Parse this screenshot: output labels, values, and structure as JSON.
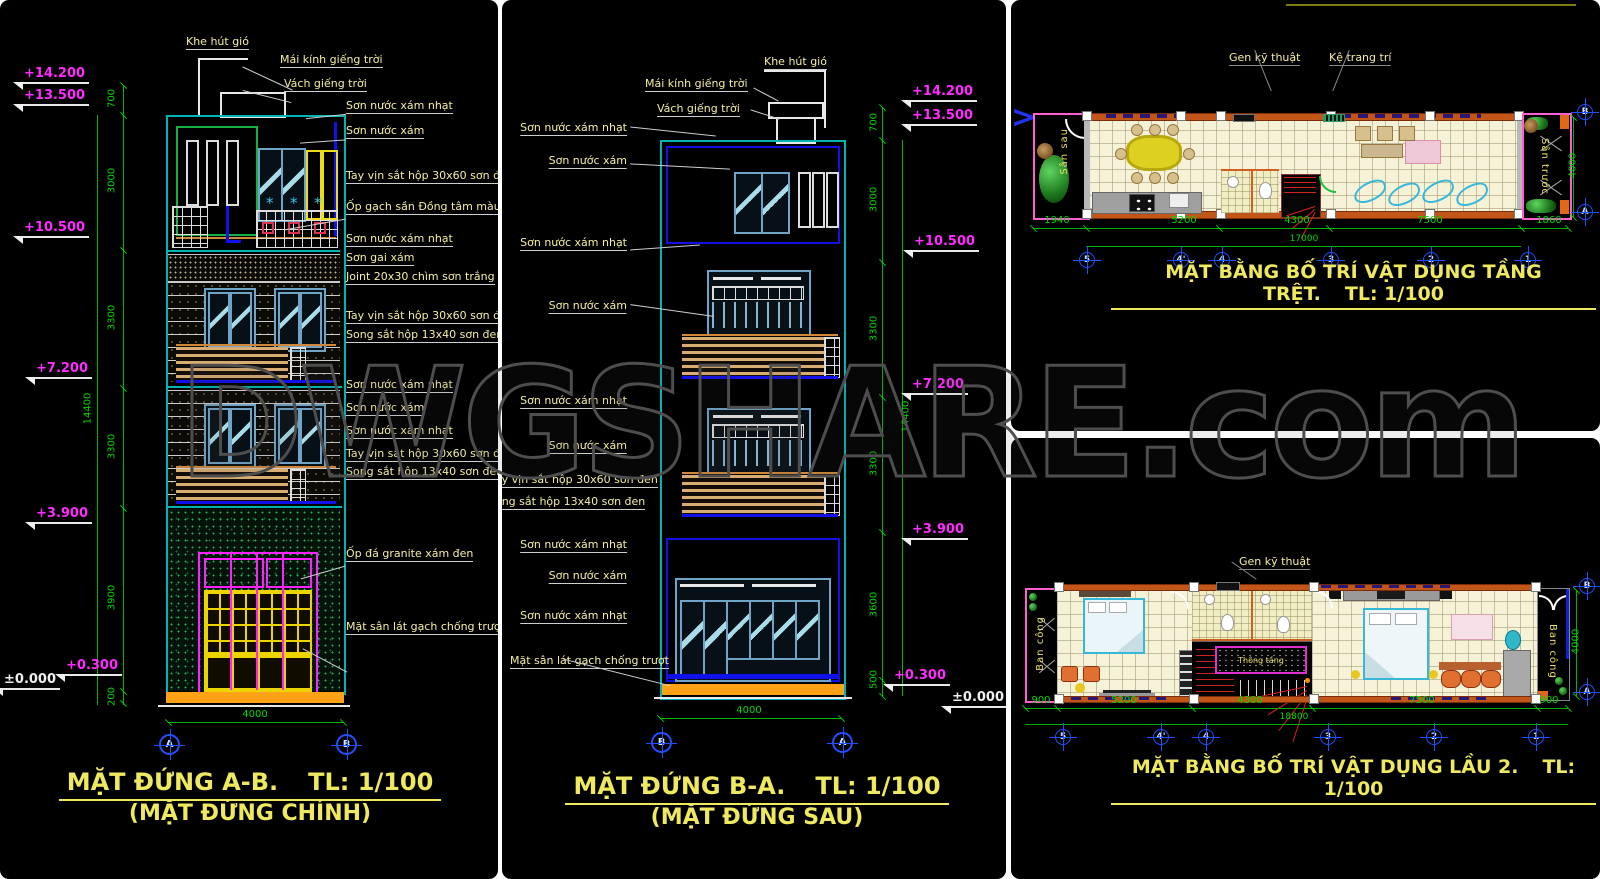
{
  "watermark": "DWGSHARE.com",
  "icons": {
    "chevron": ">",
    "plant": "*"
  },
  "front_elevation": {
    "title": "MẶT ĐỨNG A-B.",
    "scale": "TL: 1/100",
    "subtitle": "(MẶT ĐỨNG CHÍNH)",
    "roof_callouts": [
      "Khe hút gió",
      "Mái kính giếng trời",
      "Vách giếng trời"
    ],
    "material_labels": [
      "Sơn nước xám nhạt",
      "Sơn nước xám",
      "Tay vịn sắt hộp 30x60 sơn đen",
      "Ốp gạch sần Đồng tâm màu x",
      "Sơn nước xám nhạt",
      "Sơn gai xám",
      "Joint 20x30 chìm sơn trắng",
      "Tay vịn sắt hộp 30x60 sơn đen",
      "Song sắt hộp 13x40 sơn đen",
      "Sơn nước xám nhạt",
      "Sơn nước xám",
      "Sơn nước xám nhạt",
      "Tay vịn sắt hộp 30x60 sơn đen",
      "Song sắt hộp 13x40 sơn đen",
      "Ốp đá granite xám đen",
      "Mặt sân lát gạch chống trượt"
    ],
    "levels": [
      "+14.200",
      "+13.500",
      "+10.500",
      "+7.200",
      "+3.900",
      "+0.300",
      "±0.000"
    ],
    "floor_dims": [
      "700",
      "3000",
      "3300",
      "3300",
      "3900",
      "200"
    ],
    "total_height": "14400",
    "width_dim": "4000",
    "grid_bubbles": [
      "A",
      "B"
    ]
  },
  "rear_elevation": {
    "title": "MẶT ĐỨNG B-A.",
    "scale": "TL: 1/100",
    "subtitle": "(MẶT ĐỨNG SAU)",
    "roof_callouts": [
      "Mái kính giếng trời",
      "Vách giếng trời",
      "Khe hút gió"
    ],
    "material_labels": [
      "Sơn nước xám nhạt",
      "Sơn nước xám",
      "Sơn nước xám nhạt",
      "Sơn nước xám",
      "Sơn nước xám nhạt",
      "Sơn nước xám",
      "Tay vịn sắt hộp 30x60 sơn đen",
      "Song sắt hộp 13x40 sơn đen",
      "Sơn nước xám nhạt",
      "Sơn nước xám",
      "Sơn nước xám nhạt",
      "Mặt sân lát gạch chống trượt"
    ],
    "levels": [
      "+14.200",
      "+13.500",
      "+10.500",
      "+7.200",
      "+3.900",
      "+0.300",
      "±0.000"
    ],
    "floor_dims": [
      "700",
      "3000",
      "3300",
      "3300",
      "3600",
      "500"
    ],
    "total_height": "14400",
    "width_dim": "4000",
    "grid_bubbles": [
      "B",
      "A"
    ]
  },
  "ground_plan": {
    "title": "MẶT BẰNG BỐ TRÍ VẬT DỤNG TẦNG TRỆT.",
    "scale": "TL: 1/100",
    "callouts": [
      "Gen kỹ thuật",
      "Kệ trang trí"
    ],
    "area_labels": [
      "Sân sau",
      "Sân trước"
    ],
    "dims": [
      "1940",
      "5200",
      "4300",
      "7500",
      "1860"
    ],
    "total_dim": "17000",
    "depth_dim": "4000",
    "grid_cols": [
      "5",
      "4'",
      "4",
      "3",
      "2",
      "1"
    ],
    "grid_rows": [
      "B",
      "A"
    ]
  },
  "floor2_plan": {
    "title": "MẶT BẰNG BỐ TRÍ VẬT DỤNG LẦU 2.",
    "scale": "TL: 1/100",
    "callouts": [
      "Gen kỹ thuật"
    ],
    "area_labels": [
      "Ban công",
      "Ban công"
    ],
    "void_label": "Thông tầng",
    "dims": [
      "900",
      "5200",
      "4300",
      "7500",
      "900"
    ],
    "total_dim": "18800",
    "depth_dim": "4000",
    "grid_cols": [
      "5",
      "4'",
      "4",
      "3",
      "2",
      "1"
    ],
    "grid_rows": [
      "B",
      "A"
    ]
  }
}
